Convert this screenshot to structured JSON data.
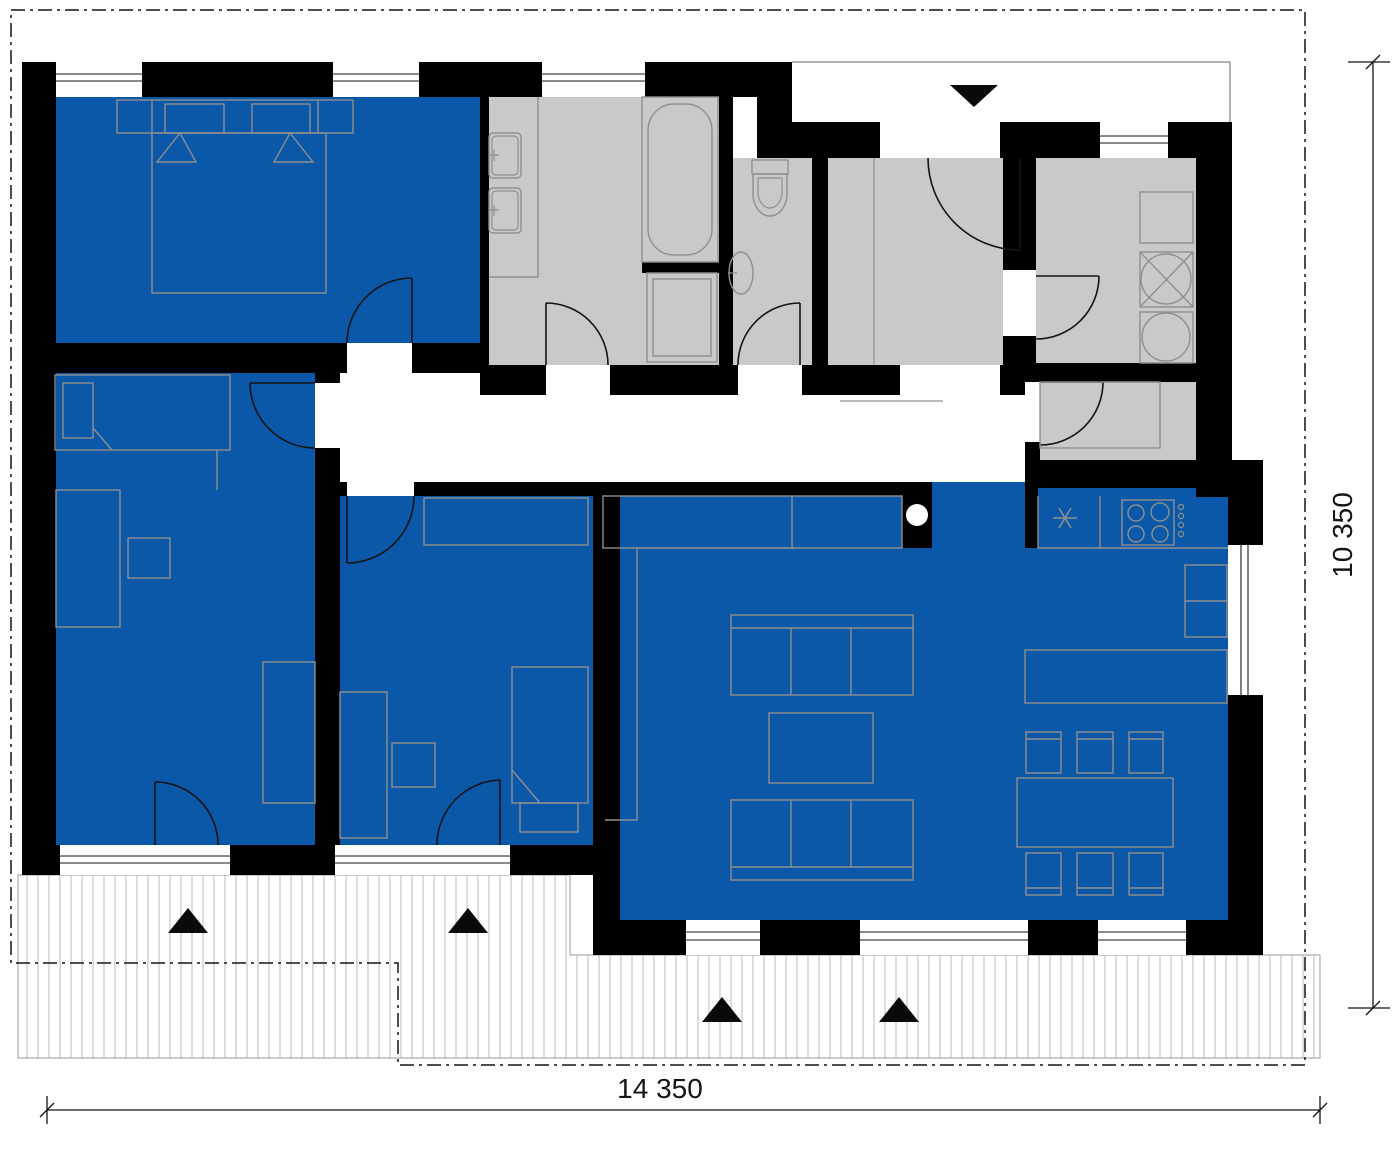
{
  "title": "single-storey house floor plan",
  "dimensions": {
    "width_label": "14 350",
    "height_label": "10 350"
  },
  "colors": {
    "wall": "#000000",
    "room_blue": "#0b57a8",
    "room_gray": "#c9c9c9",
    "furniture_line": "#8f8f8f",
    "hatch_line": "#c6c6c6"
  },
  "rooms": [
    {
      "name": "bedroom-master",
      "fill": "blue",
      "position": "top-left"
    },
    {
      "name": "bathroom",
      "fill": "gray",
      "position": "top-middle",
      "fixtures": [
        "bathtub-icon",
        "washer-icon",
        "double-sink-icon"
      ]
    },
    {
      "name": "wc",
      "fill": "gray",
      "position": "top-middle-right",
      "fixtures": [
        "toilet-icon",
        "hand-basin-icon"
      ]
    },
    {
      "name": "entrance-hall",
      "fill": "gray",
      "position": "top-right",
      "fixtures": [
        "entry-door-icon"
      ]
    },
    {
      "name": "technical-room",
      "fill": "gray",
      "position": "top-right-corner",
      "fixtures": [
        "appliance-icon",
        "washing-machine-icon",
        "dryer-icon"
      ]
    },
    {
      "name": "pantry",
      "fill": "gray",
      "position": "right-middle",
      "fixtures": [
        "shelf-icon"
      ]
    },
    {
      "name": "bedroom-left",
      "fill": "blue",
      "position": "middle-left",
      "fixtures": [
        "bed-icon",
        "wardrobe-icon"
      ]
    },
    {
      "name": "bedroom-middle",
      "fill": "blue",
      "position": "middle",
      "fixtures": [
        "bed-icon",
        "wardrobe-icon",
        "desk-icon"
      ]
    },
    {
      "name": "living-room-kitchen",
      "fill": "blue",
      "position": "bottom-right",
      "fixtures": [
        "sofa-icon",
        "coffee-table-icon",
        "dining-table-icon",
        "stove-icon",
        "fridge-icon",
        "kitchen-island-icon",
        "boiler-asterisk-icon",
        "chimney-icon"
      ]
    },
    {
      "name": "corridor",
      "fill": "white",
      "position": "middle"
    },
    {
      "name": "terrace",
      "fill": "hatched",
      "position": "bottom"
    }
  ],
  "markers": {
    "entrance_triangle": "main-entrance (points down, top porch)",
    "terrace_triangles": [
      "terrace-door bedroom-left",
      "terrace-door bedroom-middle",
      "terrace-door living-room west",
      "terrace-door living-room east"
    ]
  }
}
